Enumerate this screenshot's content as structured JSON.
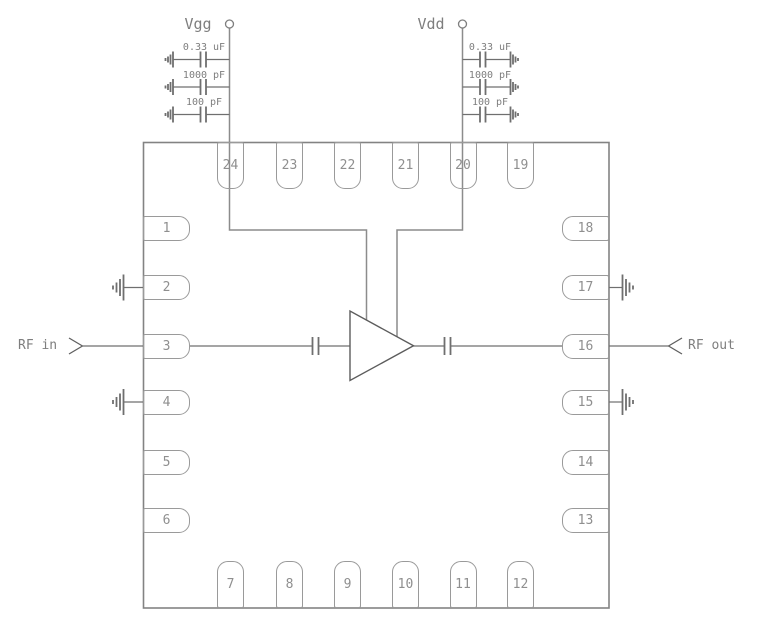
{
  "schematic": {
    "supplies": {
      "vgg": {
        "label": "Vgg",
        "capacitors": [
          {
            "value": "0.33 uF"
          },
          {
            "value": "1000 pF"
          },
          {
            "value": "100 pF"
          }
        ]
      },
      "vdd": {
        "label": "Vdd",
        "capacitors": [
          {
            "value": "0.33 uF"
          },
          {
            "value": "1000 pF"
          },
          {
            "value": "100 pF"
          }
        ]
      }
    },
    "ports": {
      "rf_in": "RF in",
      "rf_out": "RF out"
    },
    "package": {
      "pins_top": [
        "24",
        "23",
        "22",
        "21",
        "20",
        "19"
      ],
      "pins_right": [
        "18",
        "17",
        "16",
        "15",
        "14",
        "13"
      ],
      "pins_bottom": [
        "7",
        "8",
        "9",
        "10",
        "11",
        "12"
      ],
      "pins_left": [
        "1",
        "2",
        "3",
        "4",
        "5",
        "6"
      ]
    },
    "colors": {
      "wire": "#6f6f6f",
      "supply_rail": "#8c8c8c",
      "package_outline": "#838383",
      "pin_outline": "#9a9a9a",
      "amplifier": "#5c5c5c",
      "text": "#7e7e7e"
    }
  }
}
